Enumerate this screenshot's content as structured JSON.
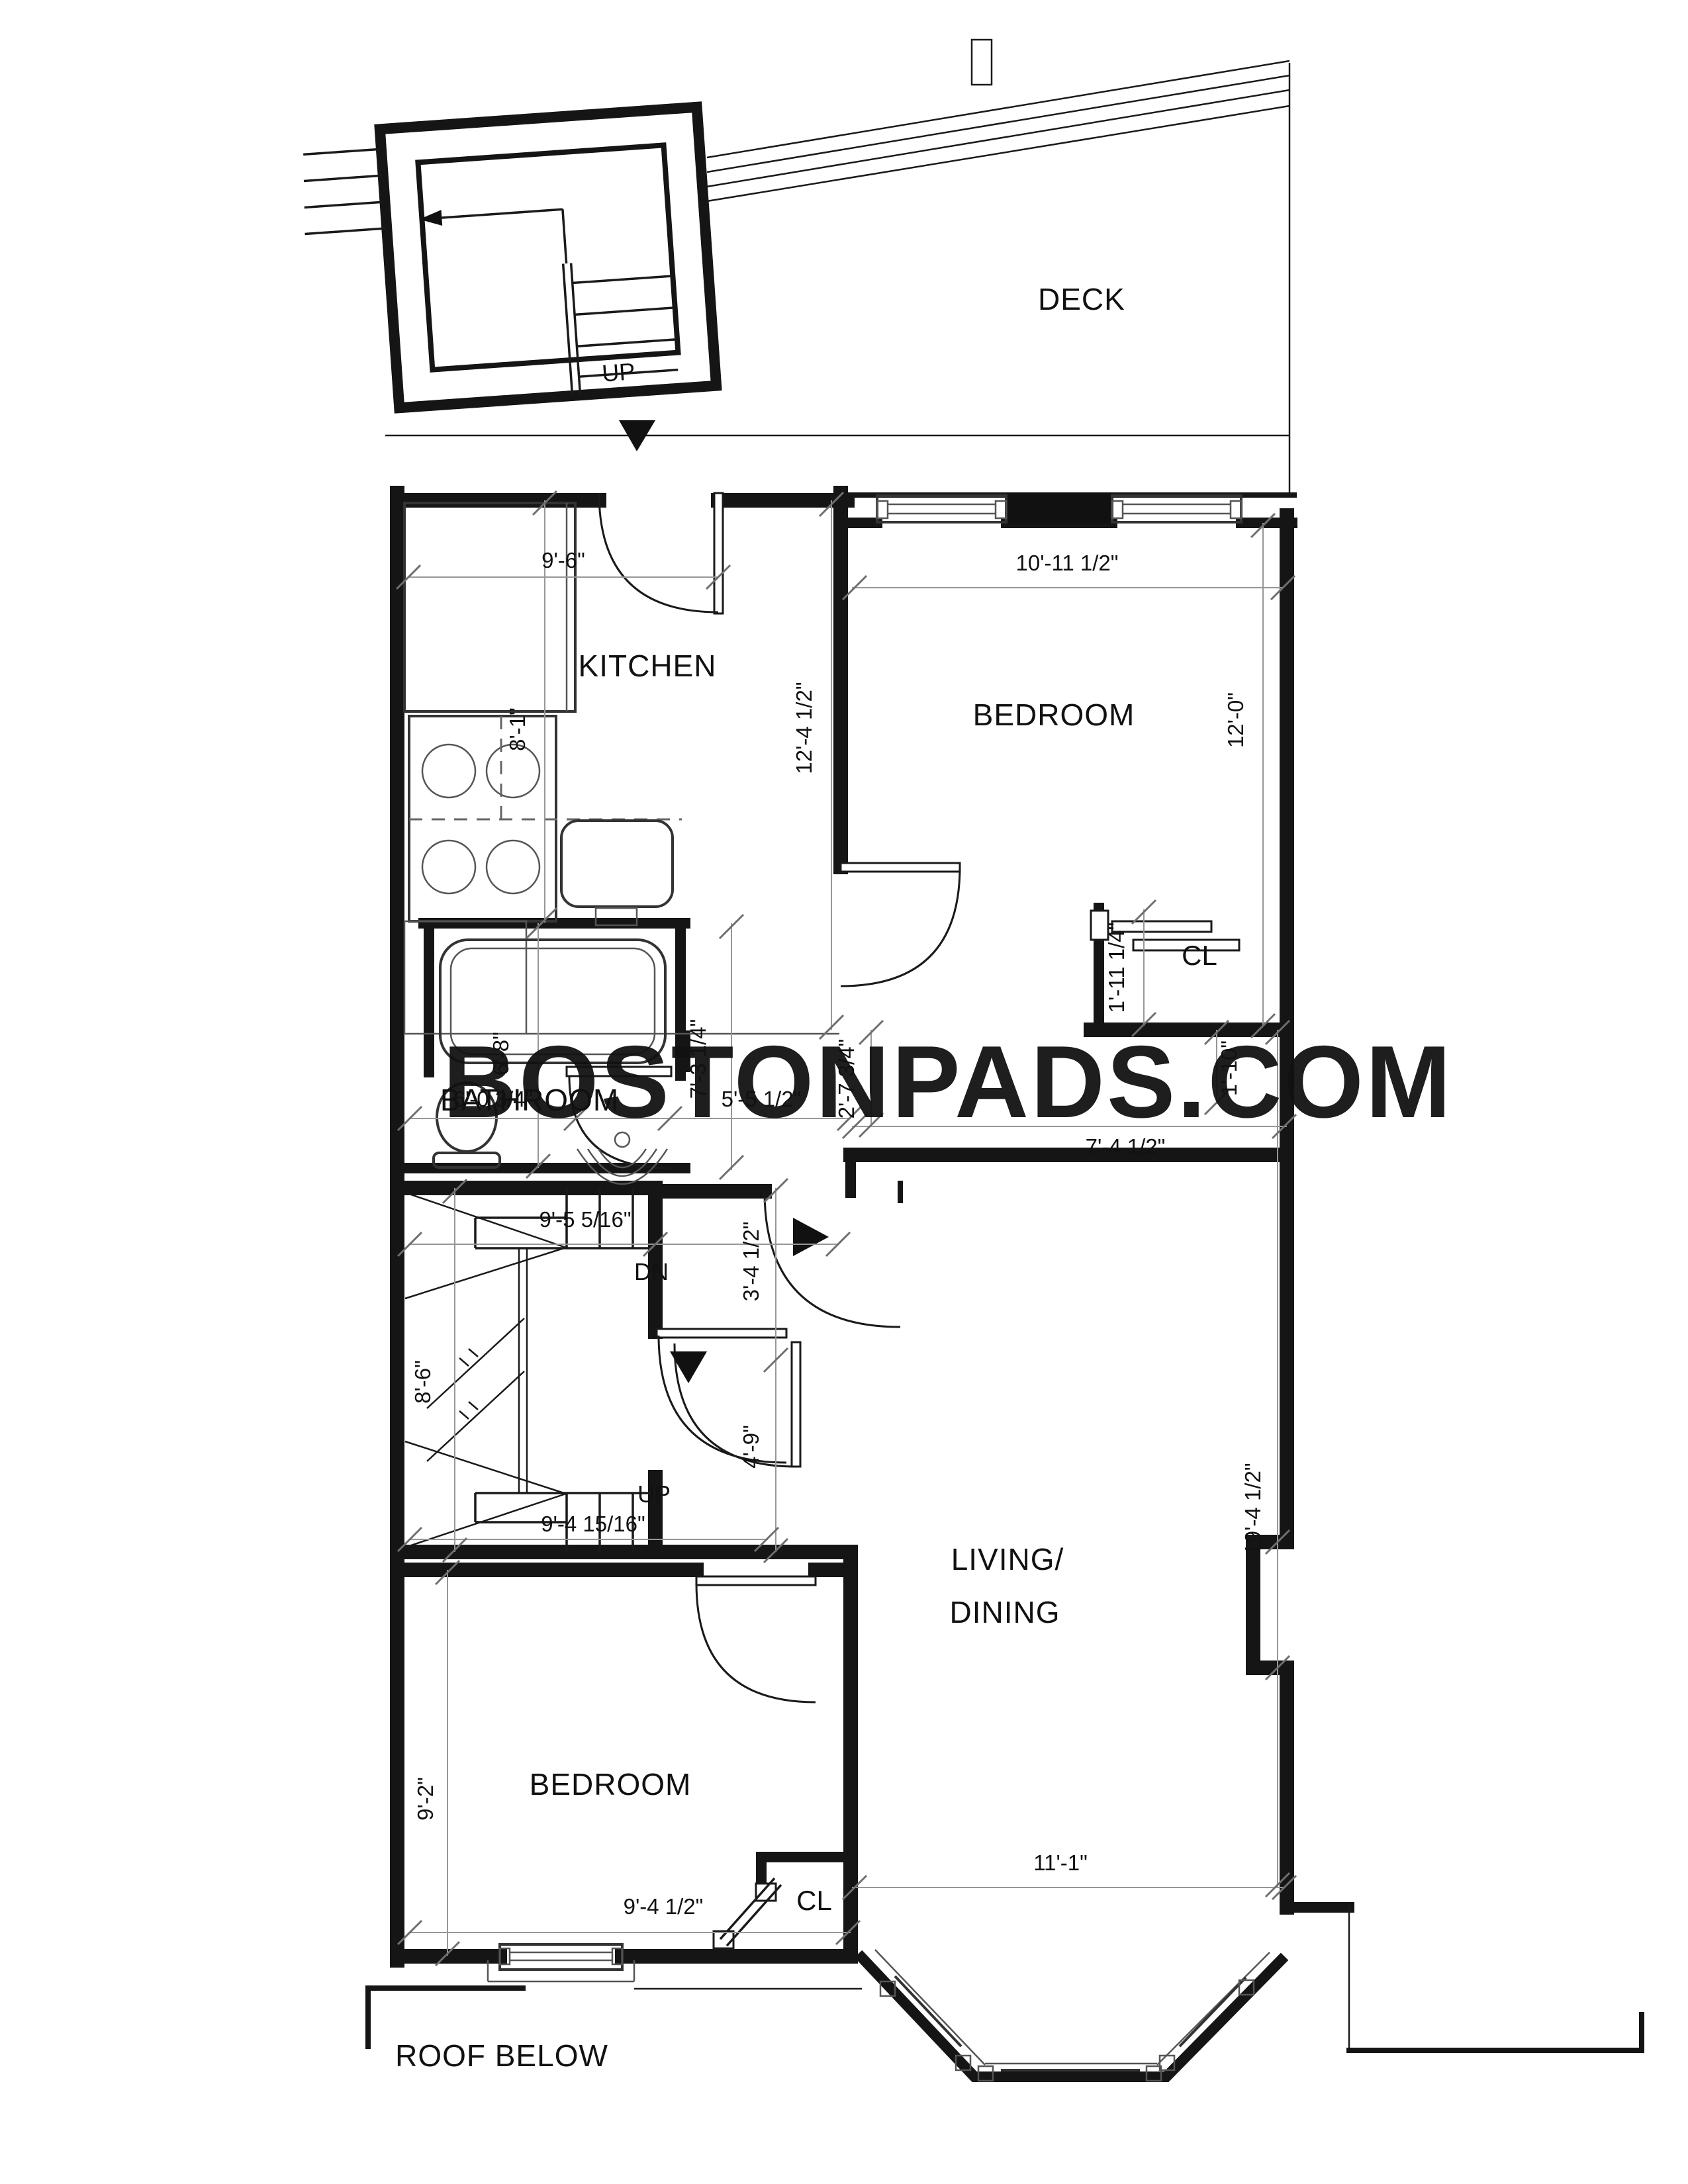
{
  "watermark": {
    "text": "BOSTONPADS.COM",
    "color": "#1c3352"
  },
  "colors": {
    "wall": "#151515",
    "dim_line": "#979797",
    "paper": "#ffffff"
  },
  "labels": {
    "deck": "DECK",
    "roof_below": "ROOF BELOW",
    "kitchen": "KITCHEN",
    "bedroom_top": "BEDROOM",
    "bathroom": "BATHROOM",
    "living_line1": "LIVING/",
    "living_line2": "DINING",
    "bedroom_bottom": "BEDROOM",
    "closet_top": "CL",
    "closet_bottom": "CL",
    "stair_up_deck": "UP",
    "stair_dn": "DN",
    "stair_up_mid": "UP"
  },
  "dims": {
    "kitchen_width": "9'-6\"",
    "kitchen_depth": "8'-1\"",
    "kitchen_wall": "12'-4 1/2\"",
    "bedroom1_width": "10'-11 1/2\"",
    "bedroom1_depth": "12'-0\"",
    "closet1_depth": "1'-11 1/4\"",
    "niche_depth": "1'-10\"",
    "hall_width": "7'-4 1/2\"",
    "bath_width": "6'-0 3/4\"",
    "hall_inner": "5'-5 1/2\"",
    "wall_jog": "2'-7 3/4\"",
    "tub_length": "6'-8\"",
    "bath_depth": "7'-3 1/4\"",
    "stair_top_width": "9'-5 5/16\"",
    "stair_run": "8'-6\"",
    "stair_bottom_width": "9'-4 15/16\"",
    "corridor_upper": "3'-4 1/2\"",
    "corridor_lower": "4'-9\"",
    "living_depth": "19'-4 1/2\"",
    "living_width": "11'-1\"",
    "bedroom2_depth": "9'-2\"",
    "bedroom2_width": "9'-4 1/2\""
  }
}
